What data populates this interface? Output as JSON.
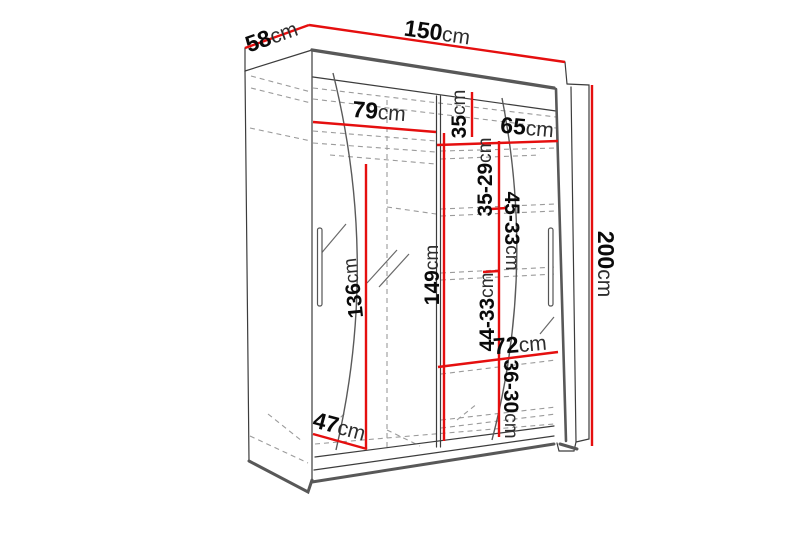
{
  "diagram": {
    "subject": "sliding-door wardrobe dimension drawing",
    "unit": "cm",
    "colors": {
      "dimension_line": "#e50f0f",
      "outline": "#3c3c3c",
      "thick_edge": "#585858",
      "hidden_line": "#999999"
    },
    "dims": {
      "d58": {
        "value": "58",
        "unit": "cm"
      },
      "d150": {
        "value": "150",
        "unit": "cm"
      },
      "d200": {
        "value": "200",
        "unit": "cm"
      },
      "d79": {
        "value": "79",
        "unit": "cm"
      },
      "d35": {
        "value": "35",
        "unit": "cm"
      },
      "d65": {
        "value": "65",
        "unit": "cm"
      },
      "g35_29": {
        "value": "35-29",
        "unit": "cm"
      },
      "g45_33": {
        "value": "45-33",
        "unit": "cm"
      },
      "g44_33": {
        "value": "44-33",
        "unit": "cm"
      },
      "d72": {
        "value": "72",
        "unit": "cm"
      },
      "g36_30": {
        "value": "36-30",
        "unit": "cm"
      },
      "d136": {
        "value": "136",
        "unit": "cm"
      },
      "d149": {
        "value": "149",
        "unit": "cm"
      },
      "d47": {
        "value": "47",
        "unit": "cm"
      }
    }
  }
}
